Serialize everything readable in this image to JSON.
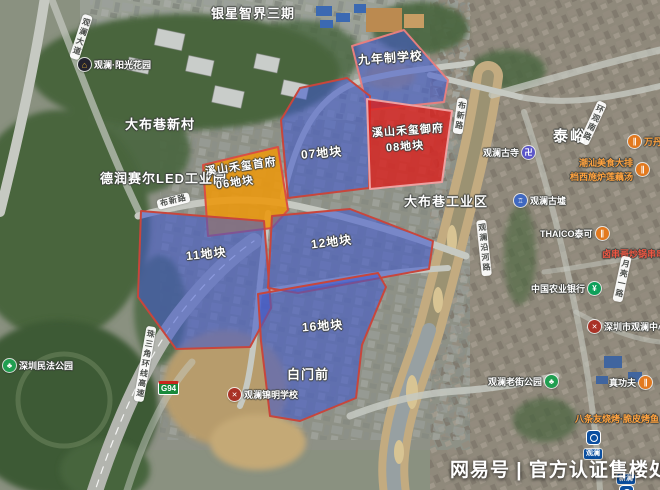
{
  "watermark": {
    "text": "网易号 | 官方认证售楼处"
  },
  "parcels": [
    {
      "key": "school",
      "label": "九年制学校",
      "type": "blue"
    },
    {
      "key": "07",
      "label": "07地块",
      "type": "blue"
    },
    {
      "key": "08",
      "dev": "溪山禾玺御府",
      "label": "08地块",
      "type": "red"
    },
    {
      "key": "06",
      "dev": "溪山禾玺首府",
      "label": "06地块",
      "type": "orange"
    },
    {
      "key": "11",
      "label": "11地块",
      "type": "blue"
    },
    {
      "key": "12",
      "label": "12地块",
      "type": "blue"
    },
    {
      "key": "16",
      "label": "16地块",
      "type": "blue"
    }
  ],
  "areas": [
    {
      "label": "银星智界三期"
    },
    {
      "label": "大布巷新村"
    },
    {
      "label": "德润赛尔LED工业园"
    },
    {
      "label": "大布巷工业区"
    },
    {
      "label": "泰峪"
    },
    {
      "label": "白门前"
    }
  ],
  "pois": [
    {
      "label": "观澜·阳光花园",
      "icon": "estate-icon"
    },
    {
      "label": "深圳民法公园",
      "icon": "park-icon"
    },
    {
      "label": "观澜古寺",
      "icon": "temple-icon"
    },
    {
      "label": "观澜古墟",
      "icon": "historic-site-icon"
    },
    {
      "label": "THAICO泰可",
      "icon": "restaurant-icon"
    },
    {
      "line1": "潮汕美食大排",
      "line2": "档西施炉莲藕汤",
      "icon": "restaurant-icon"
    },
    {
      "label": "万丹",
      "icon": "restaurant-icon"
    },
    {
      "label": "卤串哥炒锅串串香",
      "icon": "none"
    },
    {
      "label": "中国农业银行",
      "icon": "bank-icon"
    },
    {
      "label": "深圳市观澜中心小学",
      "icon": "school-icon"
    },
    {
      "label": "观澜老街公园",
      "icon": "park-icon"
    },
    {
      "label": "真功夫",
      "icon": "restaurant-icon"
    },
    {
      "label": "八条友烧烤·脆皮烤鱼",
      "icon": "restaurant-icon"
    },
    {
      "label": "观澜锦明学校",
      "icon": "school-icon"
    }
  ],
  "roads": [
    {
      "label": "观澜大道"
    },
    {
      "label": "布新路"
    },
    {
      "label": "布新路"
    },
    {
      "label": "珠三角环线高速"
    },
    {
      "label": "观澜沿河路"
    },
    {
      "label": "月亮一路"
    },
    {
      "label": "环观南路"
    }
  ],
  "badge": {
    "label": "G94"
  },
  "metro": [
    {
      "label": "观澜"
    },
    {
      "label": "新澜"
    }
  ],
  "colors": {
    "parcel_blue": "#4058cd",
    "parcel_red": "#dd1c19",
    "parcel_orange": "#ec970d",
    "parcel_border": "#c8463c",
    "poi_orange": "#ffa23e",
    "poi_red": "#ef5743",
    "metro_blue": "#0b4fa0",
    "expressway_green": "#18893b"
  }
}
